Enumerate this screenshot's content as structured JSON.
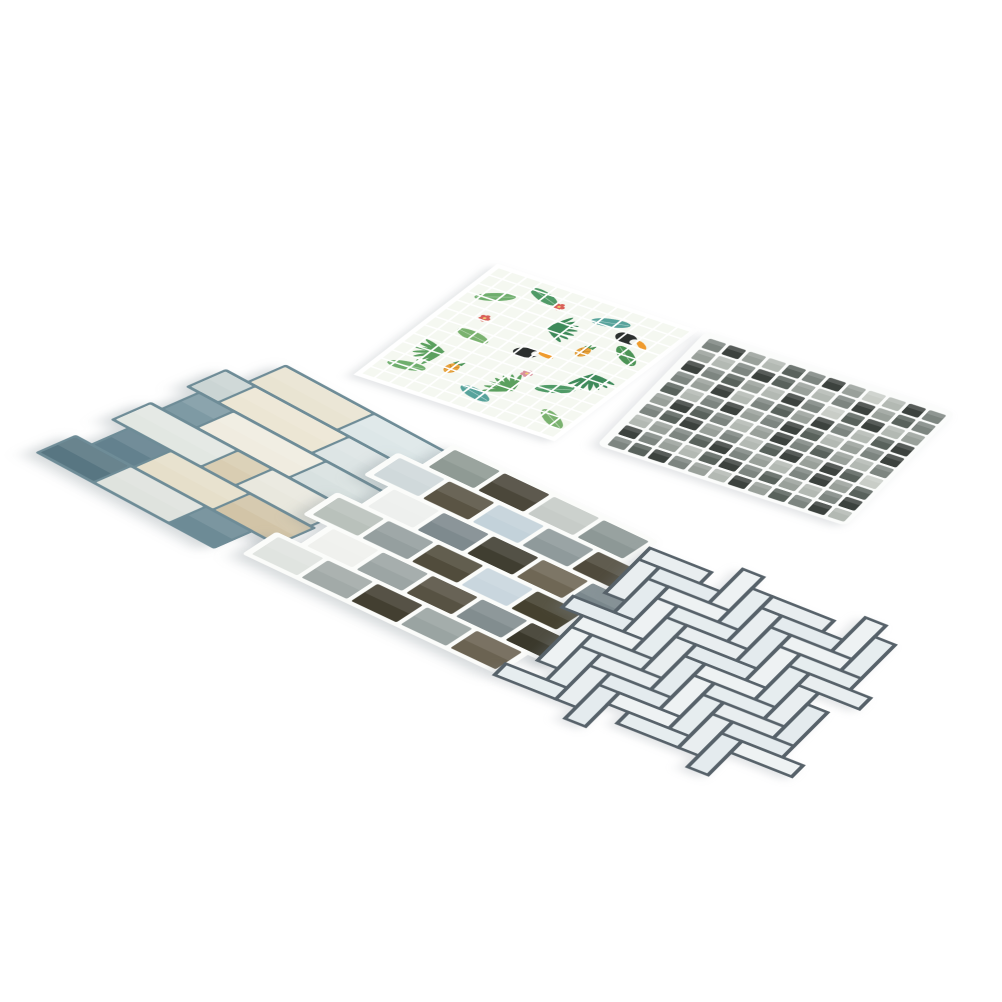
{
  "photo": {
    "background": "#ffffff",
    "subject": "five peel-and-stick mosaic tile sheets laid on white surface"
  },
  "sheets": {
    "wood_plank": {
      "grout_color": "#6e8c97",
      "tile_height": 44,
      "row_step": 48,
      "gap": 4,
      "matrix": [
        0.617,
        0.333,
        -0.783,
        0.343,
        263,
        355
      ],
      "rows": [
        {
          "offset": 36,
          "tiles": [
            {
              "w": 140,
              "c": "#e9e4d2"
            },
            {
              "w": 118,
              "c": "#dde7e8"
            }
          ]
        },
        {
          "offset": 0,
          "tiles": [
            {
              "w": 44,
              "c": "#cbd5d4"
            },
            {
              "w": 148,
              "c": "#ece6d4"
            },
            {
              "w": 112,
              "c": "#dde5e5"
            }
          ]
        },
        {
          "offset": 18,
          "tiles": [
            {
              "w": 52,
              "c": "#7e9aa4"
            },
            {
              "w": 146,
              "c": "#f0ece0"
            },
            {
              "w": 96,
              "c": "#d8e1e0"
            }
          ]
        },
        {
          "offset": 0,
          "tiles": [
            {
              "w": 138,
              "c": "#e2e7e2"
            },
            {
              "w": 52,
              "c": "#d9cdb2"
            },
            {
              "w": 118,
              "c": "#e9e8de"
            }
          ]
        },
        {
          "offset": 26,
          "tiles": [
            {
              "w": 64,
              "c": "#63818e"
            },
            {
              "w": 124,
              "c": "#e6dfca"
            },
            {
              "w": 100,
              "c": "#d2c4a7"
            }
          ]
        },
        {
          "offset": 0,
          "tiles": [
            {
              "w": 86,
              "c": "#587682"
            },
            {
              "w": 118,
              "c": "#dfe3de"
            },
            {
              "w": 70,
              "c": "#6d8b96"
            }
          ]
        }
      ]
    },
    "tropical_mosaic": {
      "background": "#f5f8f1",
      "grid": {
        "cols": 13,
        "rows": 13,
        "line_color": "#ffffff",
        "line_width": 3,
        "frame_width": 8
      },
      "matrix": [
        0.653,
        0.217,
        -0.467,
        0.36,
        498,
        266
      ],
      "leaf_colors": [
        "#6fae6d",
        "#4f9a66",
        "#57a39b",
        "#4c9456",
        "#7ab26f"
      ],
      "motifs": {
        "leaves": [
          {
            "x": 40,
            "y": 62,
            "rot": -30,
            "c": "#6fae6d"
          },
          {
            "x": 92,
            "y": 30,
            "rot": 20,
            "c": "#4f9a66"
          },
          {
            "x": 200,
            "y": 38,
            "rot": -15,
            "c": "#57a39b"
          },
          {
            "x": 262,
            "y": 92,
            "rot": 35,
            "c": "#4c9456"
          },
          {
            "x": 70,
            "y": 152,
            "rot": 10,
            "c": "#7ab26f"
          },
          {
            "x": 232,
            "y": 202,
            "rot": -25,
            "c": "#4f9a66"
          },
          {
            "x": 152,
            "y": 262,
            "rot": 15,
            "c": "#57a39b"
          },
          {
            "x": 40,
            "y": 252,
            "rot": -10,
            "c": "#6fae6d"
          },
          {
            "x": 270,
            "y": 262,
            "rot": 30,
            "c": "#7ab26f"
          }
        ],
        "fronds": [
          {
            "x": 140,
            "y": 88,
            "rot": -20,
            "c": "#3e8a5a"
          },
          {
            "x": 60,
            "y": 202,
            "rot": 150,
            "c": "#5ba05f"
          },
          {
            "x": 252,
            "y": 150,
            "rot": 60,
            "c": "#3e8a5a"
          },
          {
            "x": 188,
            "y": 232,
            "rot": 200,
            "c": "#5ba05f"
          }
        ],
        "toucans": [
          {
            "x": 150,
            "y": 150,
            "rot": -10,
            "body": "#2c302f",
            "beak": "#ef9b2d",
            "chest": "#f2f3ef"
          },
          {
            "x": 238,
            "y": 58,
            "rot": 15,
            "body": "#2c302f",
            "beak": "#ef9b2d",
            "chest": "#f2f3ef"
          }
        ],
        "pineapples": [
          {
            "x": 92,
            "y": 228,
            "body": "#e8a33d",
            "hatch": "#c07f22",
            "top": "#4c9456"
          },
          {
            "x": 210,
            "y": 112,
            "body": "#e8a33d",
            "hatch": "#c07f22",
            "top": "#4c9456"
          }
        ],
        "flowers": [
          {
            "x": 122,
            "y": 40,
            "c": "#d95f57"
          },
          {
            "x": 180,
            "y": 190,
            "c": "#d98f9c"
          },
          {
            "x": 58,
            "y": 110,
            "c": "#d95f57"
          }
        ]
      }
    },
    "gray_mosaic": {
      "backing_color": "#fbfcfb",
      "pitch": 25,
      "cell": 21,
      "cols": 12,
      "rows_count": 10,
      "matrix": [
        0.8,
        0.26,
        -0.417,
        0.433,
        709,
        337
      ],
      "palette": {
        "K": "#3c423e",
        "G": "#59625c",
        "M": "#7d8580",
        "S": "#99a09a",
        "L": "#b3b9b3",
        "F": "#c9cdc7"
      },
      "rows": [
        "MKSLGMKSFLKM",
        "SLMKGSLMKSGM",
        "KMGSLKMFGKLS",
        "MSKLMGSKMLGK",
        "GLMKSMKGLSMK",
        "SKGMLSKMGSLM",
        "MGKSMLGKSKGF",
        "LSMGKMSLMKSG",
        "KMSLGKMGSLMK",
        "MGKMSLKSGMKL"
      ]
    },
    "subway_brick": {
      "backing_color": "#fbfcfa",
      "tile_height": 40,
      "row_step": 46,
      "gap": 6,
      "brick_width": 62,
      "matrix": [
        0.73,
        0.345,
        -0.66,
        0.43,
        430,
        438
      ],
      "rows": [
        {
          "offset": 34,
          "colors": [
            "#8f9a94",
            "#4b473a",
            "#c7ccc8",
            "#8d9896"
          ]
        },
        {
          "offset": 0,
          "colors": [
            "#d0d9db",
            "#5a5444",
            "#c3d2da",
            "#8f9a9b",
            "#4f4a3c"
          ]
        },
        {
          "offset": 34,
          "colors": [
            "#eef0ee",
            "#7e8a8e",
            "#403e31",
            "#6f6755",
            "#7a878c"
          ]
        },
        {
          "offset": 0,
          "colors": [
            "#b9c1bb",
            "#959f9f",
            "#514c3c",
            "#c9d6de",
            "#45412f"
          ]
        },
        {
          "offset": 34,
          "colors": [
            "#f0f1ee",
            "#9ca5a4",
            "#575243",
            "#828d8f",
            "#3a382b"
          ]
        },
        {
          "offset": 0,
          "colors": [
            "#e0e4e0",
            "#a2aaa8",
            "#433f31",
            "#9aa4a2",
            "#6b6352"
          ]
        }
      ]
    },
    "herringbone": {
      "unit": 25,
      "grout_color": "#57626a",
      "grout_width": 4.5,
      "matrix": [
        0.817,
        0.323,
        -0.45,
        0.45,
        650,
        548
      ],
      "tile_fills": [
        "#e9eef0",
        "#e4ebee",
        "#eef2f3",
        "#e6edef"
      ],
      "bounds": [
        6,
        294
      ]
    }
  }
}
